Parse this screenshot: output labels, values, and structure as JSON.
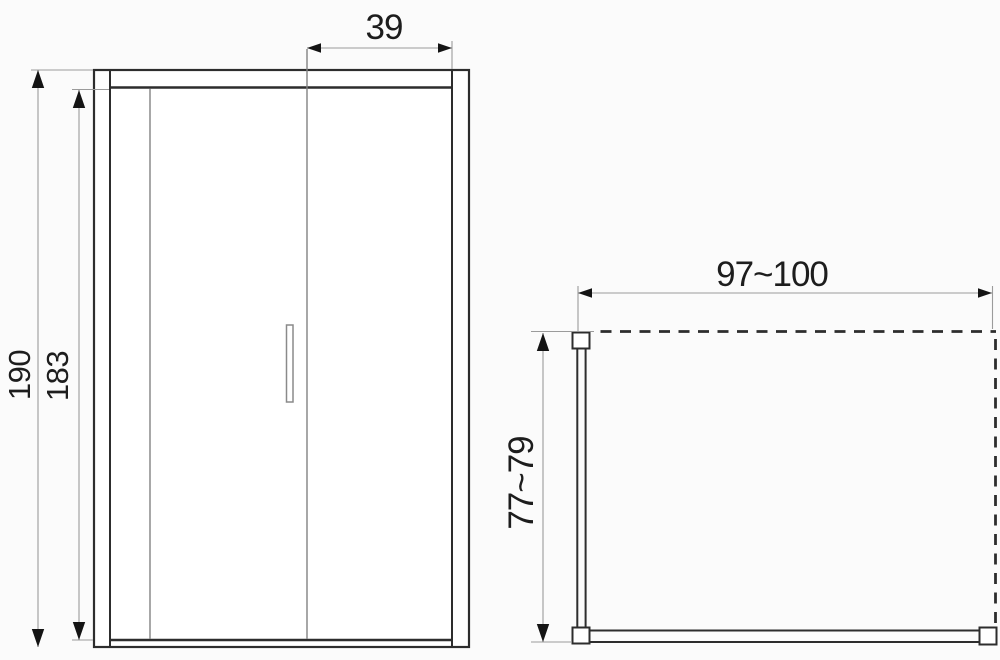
{
  "drawing": {
    "kind": "technical-dimension-drawing",
    "subject": "sliding shower door enclosure",
    "views": [
      "front-elevation",
      "top-plan"
    ]
  },
  "dimensions": [
    {
      "id": "door-panel-width",
      "label": "39",
      "view": "front",
      "orientation": "horizontal"
    },
    {
      "id": "total-height",
      "label": "190",
      "view": "front",
      "orientation": "vertical"
    },
    {
      "id": "glass-height",
      "label": "183",
      "view": "front",
      "orientation": "vertical"
    },
    {
      "id": "enclosure-width",
      "label": "97~100",
      "view": "top",
      "orientation": "horizontal"
    },
    {
      "id": "enclosure-depth",
      "label": "77~79",
      "view": "top",
      "orientation": "vertical"
    }
  ],
  "colors": {
    "background": "#fbfbfb",
    "line_dark": "#2d2d2d",
    "line_thin": "#828282",
    "line_dimension": "#9b9b9b",
    "arrow": "#141414",
    "text": "#1d1d1d"
  }
}
